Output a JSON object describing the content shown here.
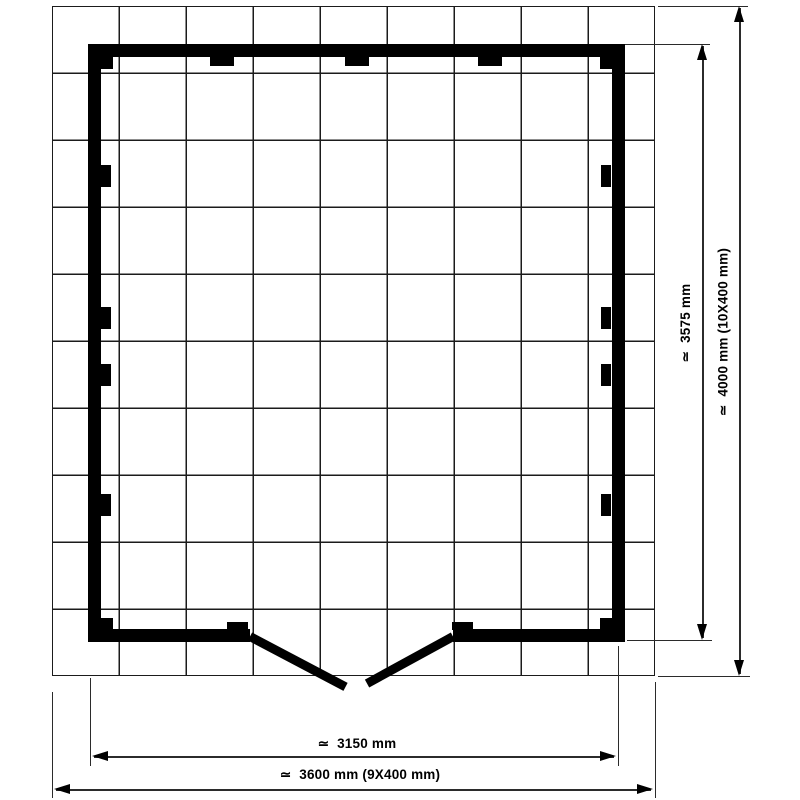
{
  "diagram": {
    "type": "floor-plan",
    "subject": "log cabin base plan with double door",
    "unit": "mm",
    "grid": {
      "columns": 9,
      "rows": 10,
      "cell_size_mm": 400,
      "grid_width_mm": 3600,
      "grid_height_mm": 4000,
      "line_color": "#1b1b1b"
    },
    "building": {
      "outer_width_mm": 3150,
      "outer_depth_mm": 3575,
      "wall_color": "#000000"
    },
    "features": {
      "door_leaves": 2,
      "door_jambs": 2,
      "corner_joints": 4,
      "wall_cleats_top": 3,
      "wall_cleats_left": 4,
      "wall_cleats_right": 4
    }
  },
  "labels": {
    "width_inner": "≃  3150 mm",
    "width_outer": "≃  3600 mm (9X400 mm)",
    "depth_inner": "≃  3575 mm",
    "depth_outer": "≃  4000 mm (10X400 mm)"
  },
  "colors": {
    "wall": "#000000",
    "dimension_line": "#2b2b2b",
    "text": "#000000",
    "background": "#ffffff"
  }
}
